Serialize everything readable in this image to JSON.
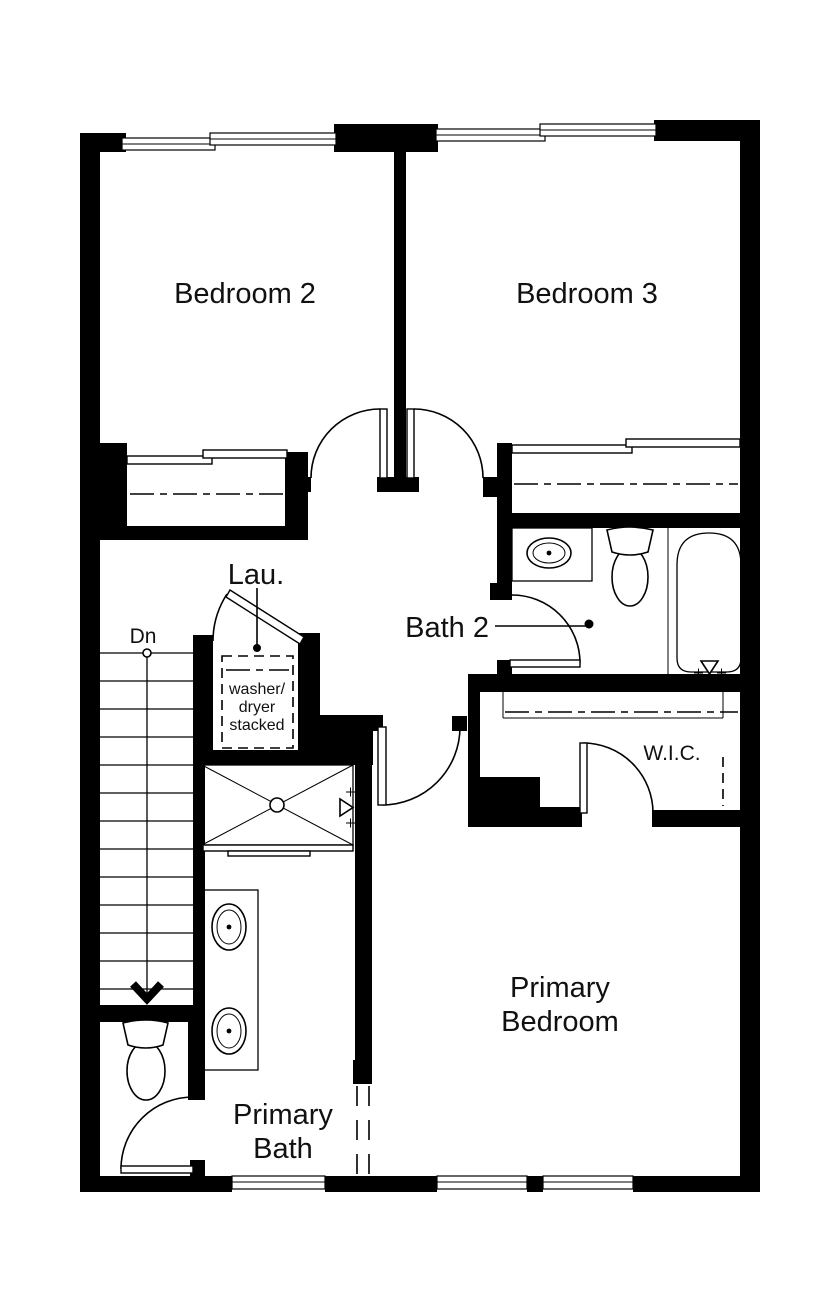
{
  "plan": {
    "labels": {
      "bedroom2": "Bedroom 2",
      "bedroom3": "Bedroom 3",
      "laundry": "Lau.",
      "bath2": "Bath 2",
      "washer_line1": "washer/",
      "washer_line2": "dryer",
      "washer_line3": "stacked",
      "wic": "W.I.C.",
      "stairs_direction": "Dn",
      "primary_bedroom_line1": "Primary",
      "primary_bedroom_line2": "Bedroom",
      "primary_bath_line1": "Primary",
      "primary_bath_line2": "Bath"
    },
    "colors": {
      "wall": "#000000",
      "line": "#000000",
      "background": "#ffffff",
      "text": "#111111"
    }
  }
}
